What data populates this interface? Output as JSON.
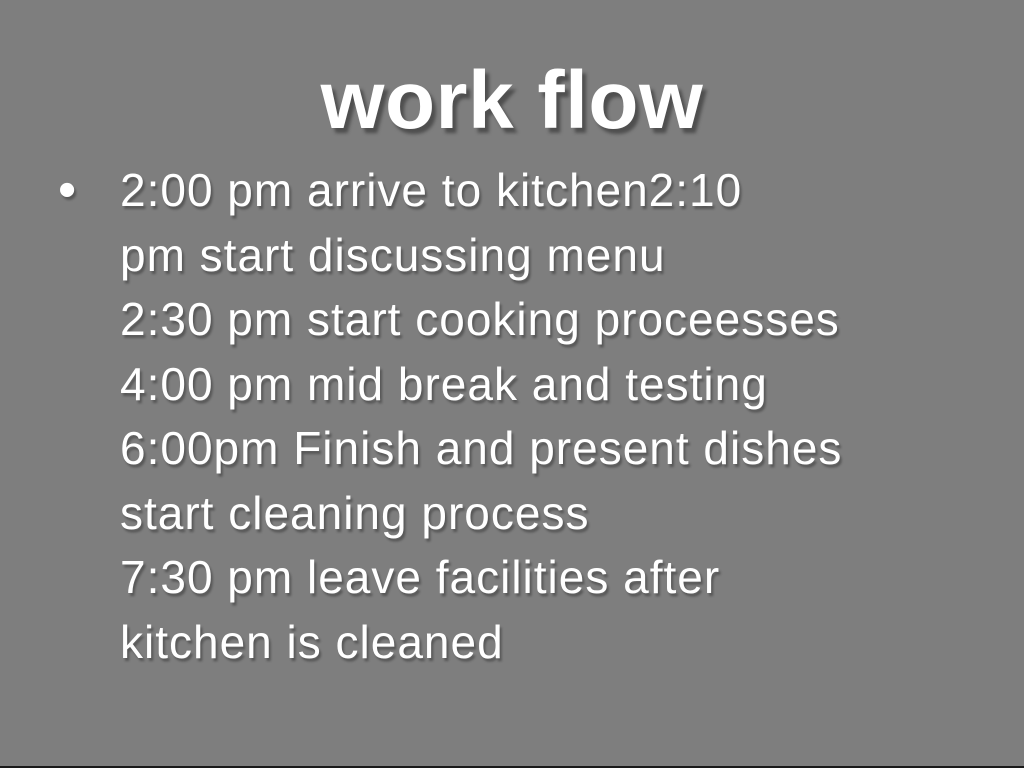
{
  "slide": {
    "title": "work flow",
    "bullet_marker": "•",
    "bullet_lines": [
      "2:00 pm arrive to kitchen2:10",
      "pm start discussing menu",
      "2:30 pm start cooking proceesses",
      "4:00 pm mid break and testing",
      "6:00pm Finish and present dishes",
      "start cleaning process",
      "7:30 pm leave facilities after",
      "kitchen is cleaned"
    ],
    "colors": {
      "background": "#7e7e7e",
      "text": "#ffffff",
      "bottom_edge": "#1a1a1a"
    }
  }
}
